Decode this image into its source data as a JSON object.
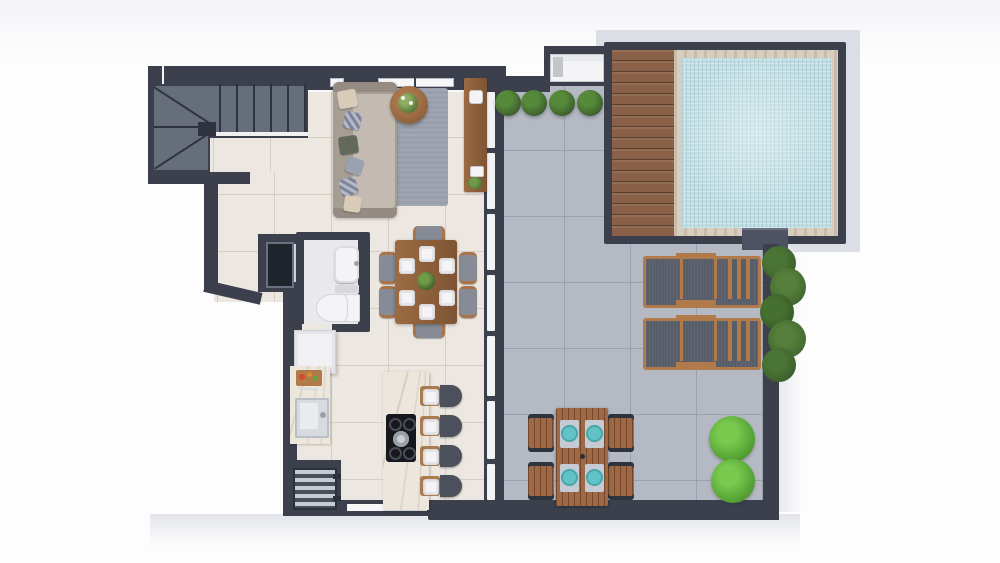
{
  "scene": {
    "type": "3d-floor-plan-top-view",
    "visible_text": "none",
    "indoor_areas": [
      "staircase",
      "living-room",
      "hallway",
      "bathroom",
      "service-shaft",
      "kitchen",
      "dining-area"
    ],
    "outdoor_areas": [
      "terrace",
      "swimming-pool",
      "wood-deck",
      "lounge-area",
      "outdoor-dining-area",
      "planter-row"
    ],
    "furniture_and_fixtures": [
      "l-shaped-staircase",
      "three-seat-sofa-with-6-pillows",
      "area-rug",
      "round-coffee-table-with-plant",
      "console-table-with-decor",
      "washbasin",
      "toilet",
      "refrigerator",
      "kitchen-counter-with-cutting-board-and-sink",
      "grill-unit",
      "kitchen-island-with-cooktop-and-pot",
      "bar-stools-x4-with-place-settings",
      "dining-table-with-6-chairs-6-plates-and-centerpiece",
      "sliding-glass-wall",
      "topiary-bushes-x4",
      "ac-condenser-unit",
      "pool-with-stone-coping",
      "sun-loungers-x2",
      "vertical-garden-hedge",
      "outdoor-dining-table-with-4-chairs-and-4-teal-plates",
      "garden-bushes-x2"
    ]
  },
  "colors": {
    "wall": "#3b404c",
    "wall_light": "#555b68",
    "interior_floor": "#ece7e0",
    "terrace_floor": "#b5b9c3",
    "pool_water": "#c2dee2",
    "pool_stone": "#d8cec0",
    "deck_wood": "#8a6148",
    "wood": "#9c6b42",
    "sofa_base": "#a69d93",
    "sofa_cushion": "#c3bbb1",
    "rug": "#99a0ac",
    "plant_dark": "#3f612e",
    "plant_bright": "#5aa839",
    "stool": "#4b505c",
    "chair_gray": "#868b96",
    "marble": "#ece6dc",
    "fixture_white": "#f4f4f6",
    "teal_plate": "#62c3c6",
    "silver": "#c6cbd3",
    "margin": "#dcdee6"
  }
}
